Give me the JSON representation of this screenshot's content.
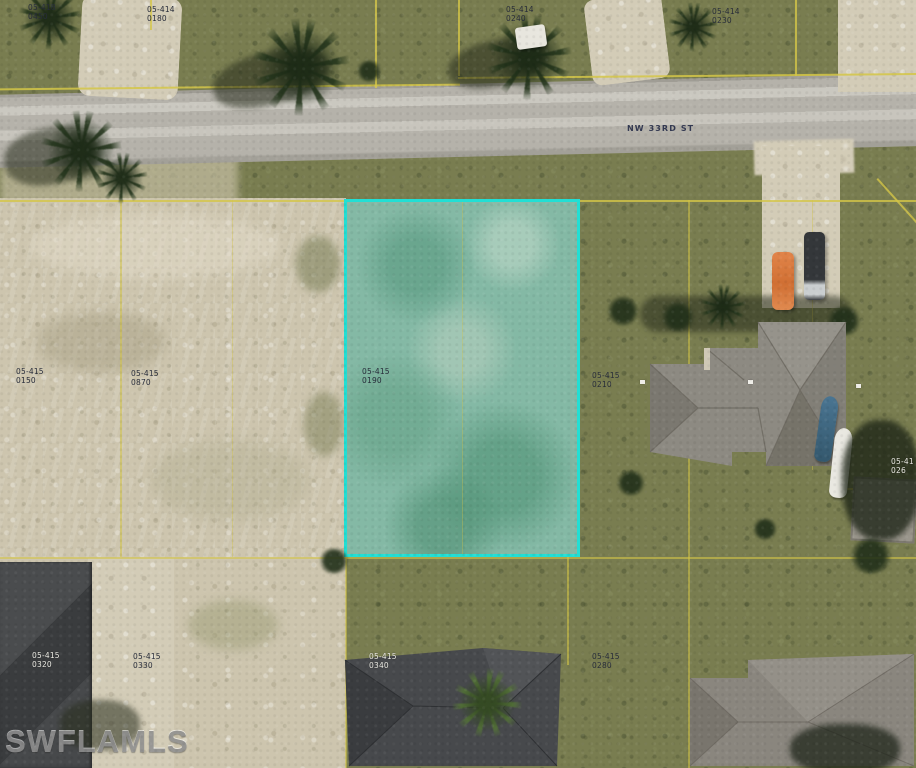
{
  "map": {
    "street_label": "NW 33RD ST",
    "watermark": "SWFLAMLS",
    "highlighted_parcel": {
      "parcel_id": "05-415 0190",
      "highlight_color": "#22dfd4"
    },
    "parcel_line_color": "#d4c547",
    "parcel_labels": [
      {
        "key": "top-left",
        "line1": "05-418",
        "line2": "0450"
      },
      {
        "key": "top-left-2",
        "line1": "05-414",
        "line2": "0180"
      },
      {
        "key": "top-center",
        "line1": "05-414",
        "line2": "0240"
      },
      {
        "key": "top-right",
        "line1": "05-414",
        "line2": "0230"
      },
      {
        "key": "mid-left",
        "line1": "05-415",
        "line2": "0150"
      },
      {
        "key": "mid-left-2",
        "line1": "05-415",
        "line2": "0870"
      },
      {
        "key": "highlight-parcel",
        "line1": "05-415",
        "line2": "0190"
      },
      {
        "key": "mid-right",
        "line1": "05-415",
        "line2": "0210"
      },
      {
        "key": "right-edge",
        "line1": "05-41",
        "line2": "026"
      },
      {
        "key": "bottom-left-roof",
        "line1": "05-415",
        "line2": "0320"
      },
      {
        "key": "bottom-left",
        "line1": "05-415",
        "line2": "0330"
      },
      {
        "key": "bottom-center",
        "line1": "05-415",
        "line2": "0340"
      },
      {
        "key": "bottom-right",
        "line1": "05-415",
        "line2": "0280"
      }
    ]
  }
}
